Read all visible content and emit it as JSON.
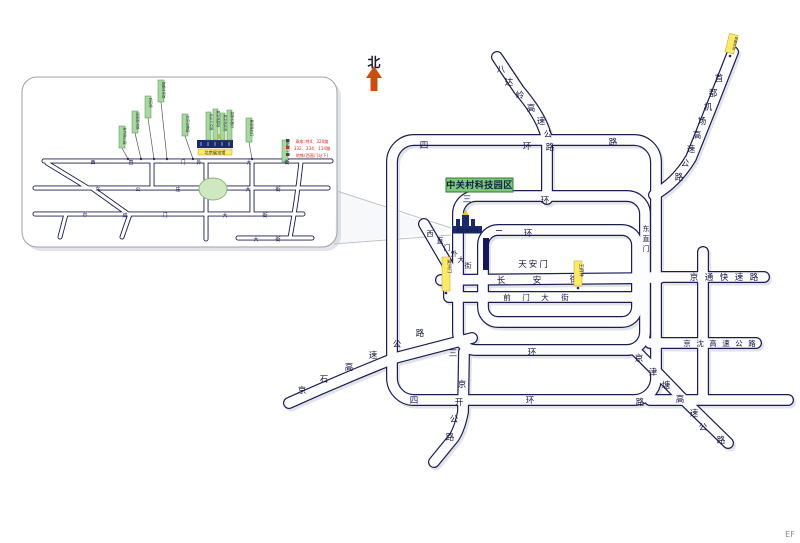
{
  "colors": {
    "road_casing": "#1c1c4f",
    "tag_green": "#a8d8a0",
    "tag_yellow": "#ffe96b",
    "venue_navy": "#1b2a6b",
    "zone_green": "#7dc87d",
    "north_arrow": "#c84f12"
  },
  "main_map": {
    "north_label": "北",
    "zone_box": "中关村科技园区",
    "tiananmen": "天安门",
    "venue_label": "北京展览馆",
    "roads": {
      "ring4_top": [
        "四",
        "环",
        "路"
      ],
      "ring3_top": [
        "三",
        "环"
      ],
      "ring2_top": [
        "二",
        "环"
      ],
      "ring3_bottom": [
        "三",
        "环"
      ],
      "ring4_bottom": [
        "四",
        "环",
        "路"
      ],
      "changan": [
        "长",
        "安",
        "街"
      ],
      "qianmen": [
        "前",
        "门",
        "大",
        "街"
      ],
      "xizhimenwai": [
        "西",
        "直",
        "门",
        "外",
        "大",
        "街"
      ],
      "badaling": [
        "八",
        "达",
        "岭",
        "高",
        "速",
        "公",
        "路"
      ],
      "airport_expwy": [
        "首",
        "都",
        "机",
        "场",
        "高",
        "速",
        "公",
        "路"
      ],
      "jingtong": [
        "京",
        "通",
        "快",
        "速",
        "路"
      ],
      "jingshen": [
        "京",
        "沈",
        "高",
        "速",
        "公",
        "路"
      ],
      "jingjintang": [
        "京",
        "津",
        "塘",
        "高",
        "速",
        "公",
        "路"
      ],
      "jingshi": [
        "京",
        "石",
        "高",
        "速",
        "公",
        "路"
      ],
      "jingkai": [
        "京",
        "开",
        "公",
        "路"
      ],
      "dongzhimen": [
        "东",
        "直",
        "门"
      ]
    },
    "tags": {
      "airport_terminal": "首都机场",
      "changan_west": "复兴门",
      "changan_east": "王府井"
    }
  },
  "inset": {
    "streets": {
      "xizhimenwai": [
        "西",
        "直",
        "门",
        "外",
        "大",
        "街"
      ],
      "chegongzhuang": [
        "车",
        "公",
        "庄",
        "大",
        "街"
      ],
      "fuchengmen": [
        "阜",
        "成",
        "门",
        "大",
        "街"
      ],
      "south": [
        "大",
        "街"
      ]
    },
    "venue_bar_label": "北京展览馆",
    "tags_left": [
      "紫竹院公园",
      "国家图书馆",
      "白石桥",
      "首都体育馆"
    ],
    "tag_zoo": "北京动物园",
    "tags_cluster": [
      "北京天文馆",
      "展览馆剧场",
      "展览馆宾馆",
      "莫斯科餐厅"
    ],
    "tag_east_a": "展览路北口",
    "tag_east_b": "西直门",
    "legend": [
      "乘车:特4、320路",
      "332、334、114路",
      "地铁(西直门站下)"
    ]
  },
  "footer": {
    "corner_mark": "EF"
  }
}
